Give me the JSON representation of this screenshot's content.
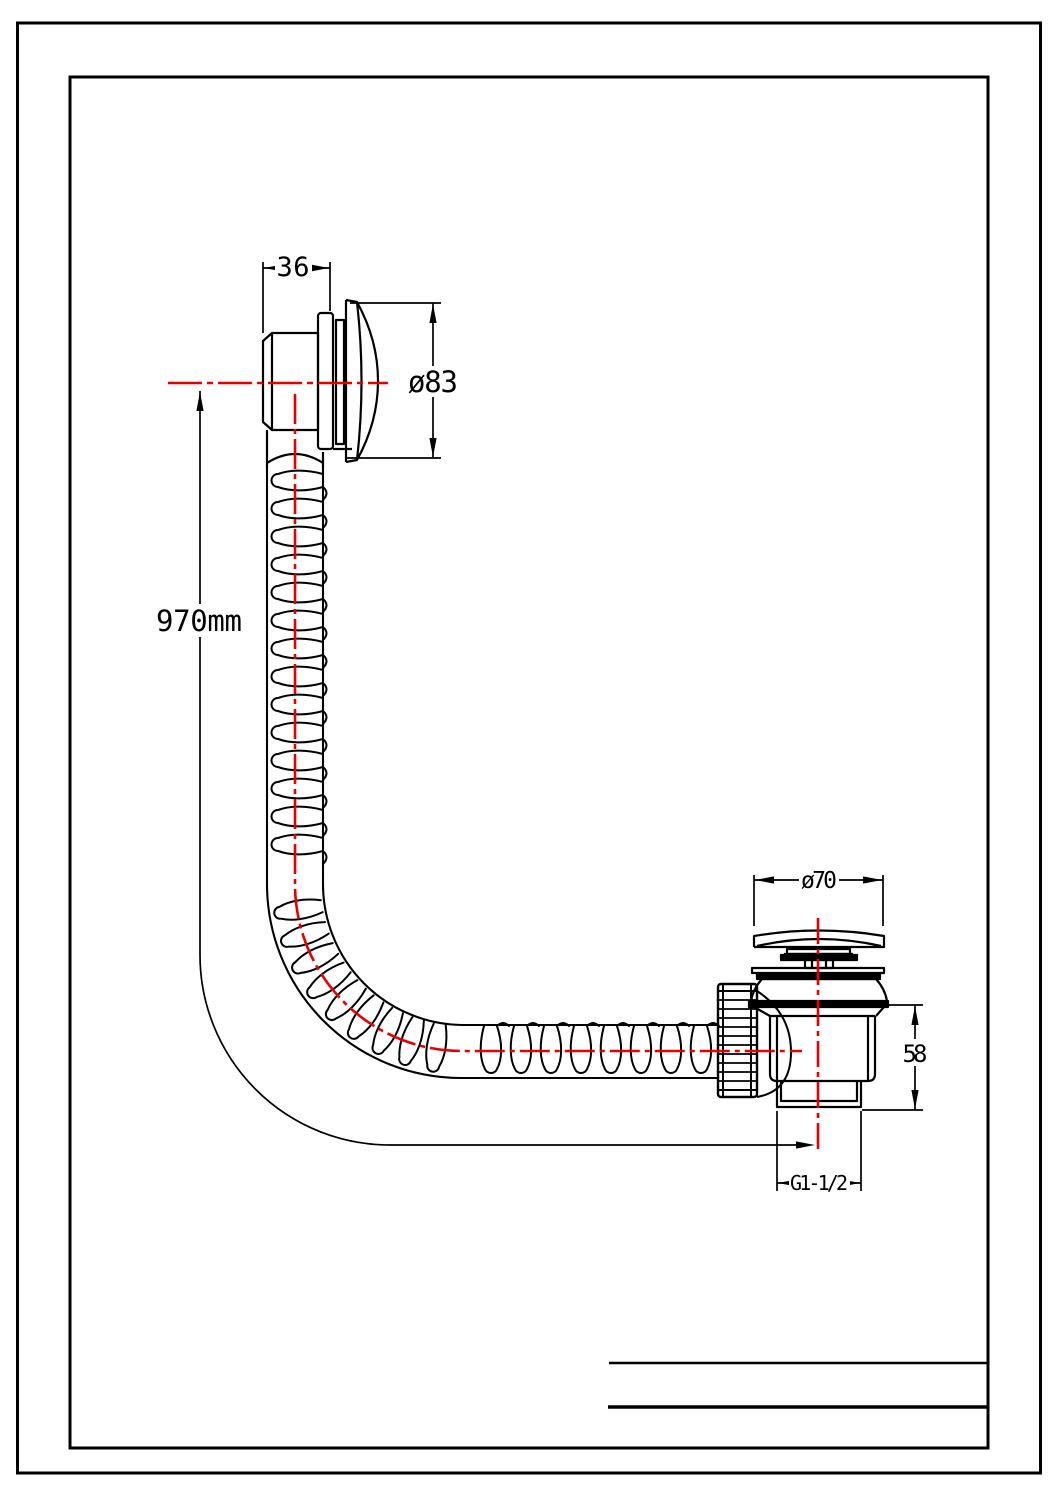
{
  "drawing": {
    "type": "technical-drawing",
    "subject": "Bath overflow filler and waste trap connected by flexible corrugated hose, dimensioned side view",
    "colors": {
      "line": "#000000",
      "centerline": "#e60000",
      "background": "#ffffff"
    },
    "dimensions": {
      "overflow_body_width": "36",
      "overflow_cover_diameter": "ø83",
      "hose_length": "970mm",
      "waste_cap_diameter": "ø70",
      "waste_body_height": "58",
      "waste_outlet_thread": "G1-1/2"
    }
  }
}
